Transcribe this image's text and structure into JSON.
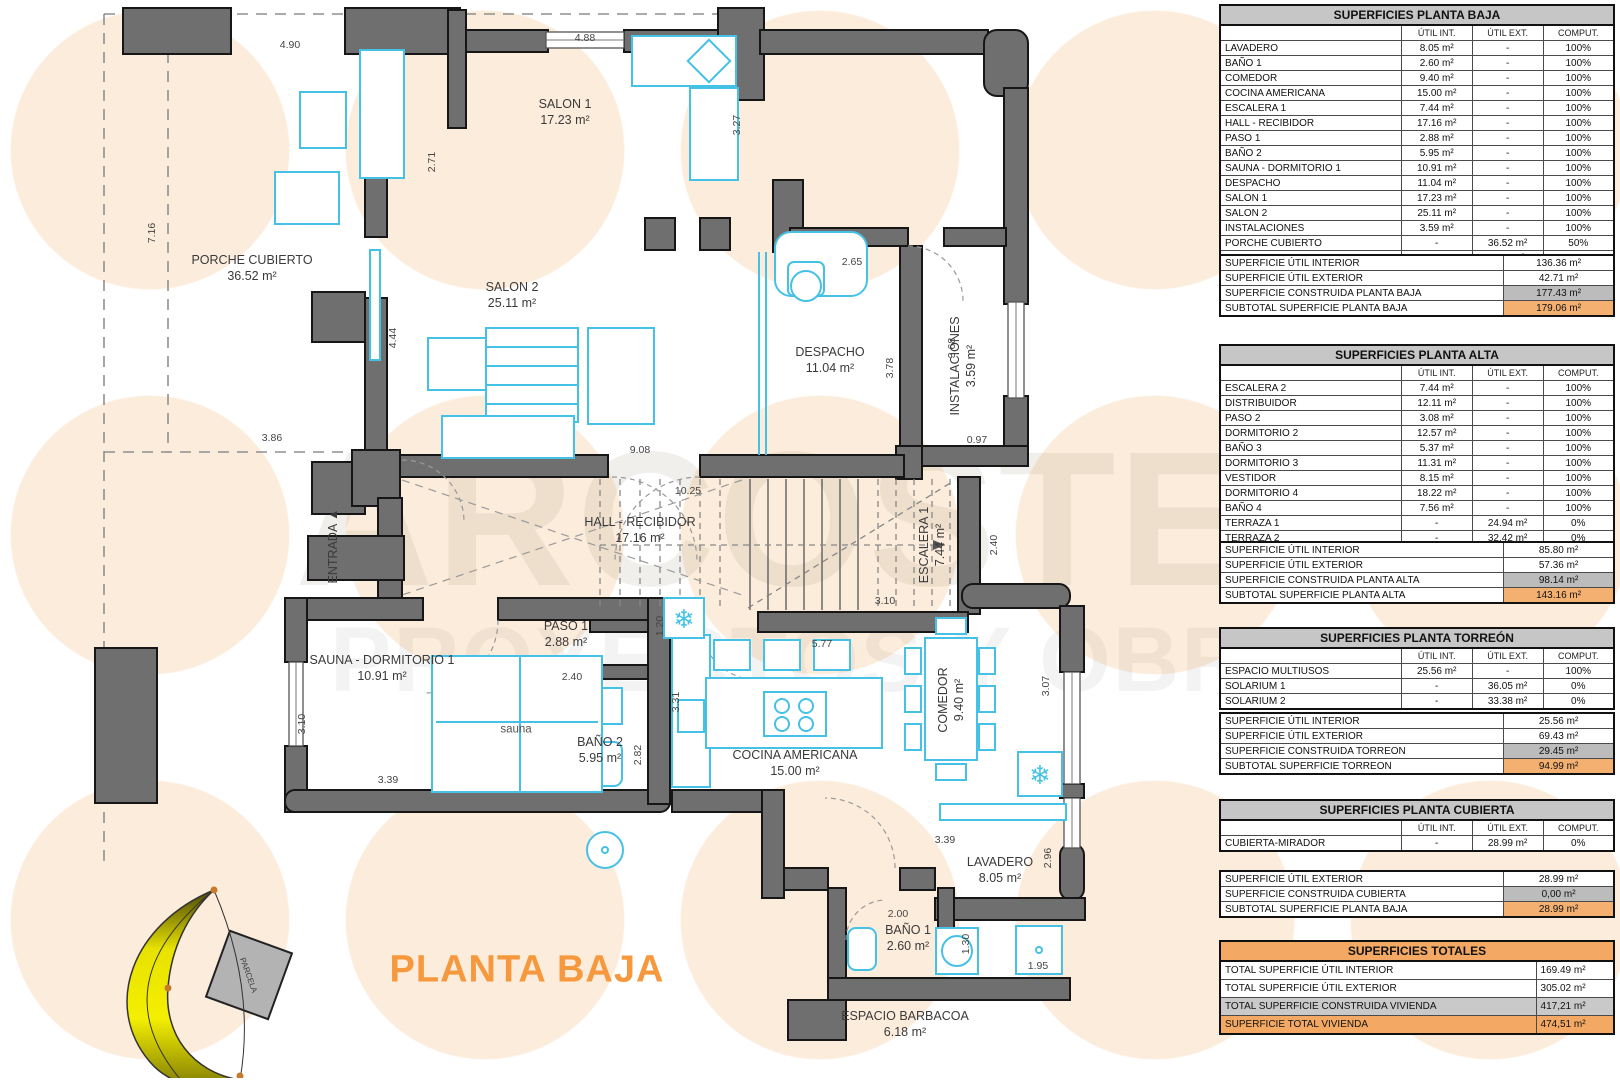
{
  "title": "PLANTA BAJA",
  "watermark": {
    "line1": "ARCOSTEC",
    "line2": "PROYECTOS Y OBRAS"
  },
  "colors": {
    "accent_orange": "#F6993E",
    "table_header_gray": "#C6C6C6",
    "highlight_gray": "#BCBCBC",
    "highlight_orange": "#F3B071",
    "totals_header_orange": "#F3A963",
    "wall_gray": "#6F6F6F",
    "furniture_cyan": "#45C1E5",
    "sun_yellow": "#E8E200"
  },
  "plan": {
    "rooms": [
      {
        "name": "PORCHE CUBIERTO",
        "area": "36.52 m²"
      },
      {
        "name": "SALON 1",
        "area": "17.23 m²"
      },
      {
        "name": "SALON 2",
        "area": "25.11 m²"
      },
      {
        "name": "DESPACHO",
        "area": "11.04 m²"
      },
      {
        "name": "INSTALACIONES",
        "area": "3.59 m²"
      },
      {
        "name": "HALL - RECIBIDOR",
        "area": "17.16 m²"
      },
      {
        "name": "ESCALERA 1",
        "area": "7.44 m²"
      },
      {
        "name": "SAUNA - DORMITORIO 1",
        "area": "10.91 m²"
      },
      {
        "name": "PASO 1",
        "area": "2.88 m²"
      },
      {
        "name": "BAÑO 2",
        "area": "5.95 m²"
      },
      {
        "name": "COCINA AMERICANA",
        "area": "15.00 m²"
      },
      {
        "name": "COMEDOR",
        "area": "9.40 m²"
      },
      {
        "name": "LAVADERO",
        "area": "8.05 m²"
      },
      {
        "name": "BAÑO 1",
        "area": "2.60 m²"
      },
      {
        "name": "ESPACIO BARBACOA",
        "area": "6.18 m²"
      }
    ],
    "labels": {
      "sauna": "sauna",
      "entrada": "ENTRADA",
      "parcela": "PARCELA"
    },
    "dims": [
      "4.90",
      "7.16",
      "2.71",
      "4.88",
      "3.27",
      "4.44",
      "3.86",
      "9.08",
      "2.65",
      "3.78",
      "3.68",
      "0.97",
      "10.25",
      "2.40",
      "3.10",
      "5.77",
      "1.20",
      "3.31",
      "2.40",
      "2.82",
      "3.10",
      "3.39",
      "3.07",
      "3.39",
      "2.96",
      "2.00",
      "1.30",
      "1.95"
    ]
  },
  "tables": {
    "baja": {
      "title": "SUPERFICIES PLANTA BAJA",
      "columns": [
        "ÚTIL INT.",
        "ÚTIL EXT.",
        "COMPUT."
      ],
      "rows": [
        {
          "name": "LAVADERO",
          "int": "8.05 m²",
          "ext": "-",
          "comp": "100%"
        },
        {
          "name": "BAÑO 1",
          "int": "2.60 m²",
          "ext": "-",
          "comp": "100%"
        },
        {
          "name": "COMEDOR",
          "int": "9.40 m²",
          "ext": "-",
          "comp": "100%"
        },
        {
          "name": "COCINA AMERICANA",
          "int": "15.00 m²",
          "ext": "-",
          "comp": "100%"
        },
        {
          "name": "ESCALERA 1",
          "int": "7.44 m²",
          "ext": "-",
          "comp": "100%"
        },
        {
          "name": "HALL - RECIBIDOR",
          "int": "17.16 m²",
          "ext": "-",
          "comp": "100%"
        },
        {
          "name": "PASO 1",
          "int": "2.88 m²",
          "ext": "-",
          "comp": "100%"
        },
        {
          "name": "BAÑO 2",
          "int": "5.95 m²",
          "ext": "-",
          "comp": "100%"
        },
        {
          "name": "SAUNA - DORMITORIO 1",
          "int": "10.91 m²",
          "ext": "-",
          "comp": "100%"
        },
        {
          "name": "DESPACHO",
          "int": "11.04 m²",
          "ext": "-",
          "comp": "100%"
        },
        {
          "name": "SALON 1",
          "int": "17.23 m²",
          "ext": "-",
          "comp": "100%"
        },
        {
          "name": "SALON 2",
          "int": "25.11 m²",
          "ext": "-",
          "comp": "100%"
        },
        {
          "name": "INSTALACIONES",
          "int": "3.59 m²",
          "ext": "-",
          "comp": "100%"
        },
        {
          "name": "PORCHE CUBIERTO",
          "int": "-",
          "ext": "36.52 m²",
          "comp": "50%"
        },
        {
          "name": "ESPACIO BARBACOA",
          "int": "-",
          "ext": "6.18 m²",
          "comp": "0%"
        }
      ]
    },
    "baja_summary": {
      "rows": [
        {
          "label": "SUPERFICIE ÚTIL INTERIOR",
          "value": "136.36 m²"
        },
        {
          "label": "SUPERFICIE ÚTIL EXTERIOR",
          "value": "42.71 m²"
        },
        {
          "label": "SUPERFICIE CONSTRUIDA PLANTA BAJA",
          "value": "177.43 m²"
        },
        {
          "label": "SUBTOTAL SUPERFICIE PLANTA BAJA",
          "value": "179.06 m²"
        }
      ]
    },
    "alta": {
      "title": "SUPERFICIES PLANTA ALTA",
      "columns": [
        "ÚTIL INT.",
        "ÚTIL EXT.",
        "COMPUT."
      ],
      "rows": [
        {
          "name": "ESCALERA 2",
          "int": "7.44 m²",
          "ext": "-",
          "comp": "100%"
        },
        {
          "name": "DISTRIBUIDOR",
          "int": "12.11 m²",
          "ext": "-",
          "comp": "100%"
        },
        {
          "name": "PASO 2",
          "int": "3.08 m²",
          "ext": "-",
          "comp": "100%"
        },
        {
          "name": "DORMITORIO 2",
          "int": "12.57 m²",
          "ext": "-",
          "comp": "100%"
        },
        {
          "name": "BAÑO 3",
          "int": "5.37 m²",
          "ext": "-",
          "comp": "100%"
        },
        {
          "name": "DORMITORIO 3",
          "int": "11.31 m²",
          "ext": "-",
          "comp": "100%"
        },
        {
          "name": "VESTIDOR",
          "int": "8.15 m²",
          "ext": "-",
          "comp": "100%"
        },
        {
          "name": "DORMITORIO 4",
          "int": "18.22 m²",
          "ext": "-",
          "comp": "100%"
        },
        {
          "name": "BAÑO 4",
          "int": "7.56 m²",
          "ext": "-",
          "comp": "100%"
        },
        {
          "name": "TERRAZA 1",
          "int": "-",
          "ext": "24.94 m²",
          "comp": "0%"
        },
        {
          "name": "TERRAZA 2",
          "int": "-",
          "ext": "32.42 m²",
          "comp": "0%"
        }
      ]
    },
    "alta_summary": {
      "rows": [
        {
          "label": "SUPERFICIE ÚTIL INTERIOR",
          "value": "85.80 m²"
        },
        {
          "label": "SUPERFICIE ÚTIL EXTERIOR",
          "value": "57.36 m²"
        },
        {
          "label": "SUPERFICIE CONSTRUIDA PLANTA ALTA",
          "value": "98.14 m²"
        },
        {
          "label": "SUBTOTAL SUPERFICIE PLANTA ALTA",
          "value": "143.16 m²"
        }
      ]
    },
    "torreon": {
      "title": "SUPERFICIES PLANTA TORREÓN",
      "columns": [
        "ÚTIL INT.",
        "ÚTIL EXT.",
        "COMPUT."
      ],
      "rows": [
        {
          "name": "ESPACIO MULTIUSOS",
          "int": "25.56 m²",
          "ext": "-",
          "comp": "100%"
        },
        {
          "name": "SOLARIUM 1",
          "int": "-",
          "ext": "36.05 m²",
          "comp": "0%"
        },
        {
          "name": "SOLARIUM 2",
          "int": "-",
          "ext": "33.38 m²",
          "comp": "0%"
        }
      ]
    },
    "torreon_summary": {
      "rows": [
        {
          "label": "SUPERFICIE ÚTIL INTERIOR",
          "value": "25.56 m²"
        },
        {
          "label": "SUPERFICIE ÚTIL EXTERIOR",
          "value": "69.43 m²"
        },
        {
          "label": "SUPERFICIE CONSTRUIDA TORREON",
          "value": "29.45 m²"
        },
        {
          "label": "SUBTOTAL SUPERFICIE TORREON",
          "value": "94.99 m²"
        }
      ]
    },
    "cubierta": {
      "title": "SUPERFICIES PLANTA CUBIERTA",
      "columns": [
        "ÚTIL INT.",
        "ÚTIL EXT.",
        "COMPUT."
      ],
      "rows": [
        {
          "name": "CUBIERTA-MIRADOR",
          "int": "-",
          "ext": "28.99 m²",
          "comp": "0%"
        }
      ]
    },
    "cubierta_summary": {
      "rows": [
        {
          "label": "SUPERFICIE ÚTIL EXTERIOR",
          "value": "28.99 m²"
        },
        {
          "label": "SUPERFICIE CONSTRUIDA CUBIERTA",
          "value": "0,00 m²"
        },
        {
          "label": "SUBTOTAL SUPERFICIE PLANTA BAJA",
          "value": "28.99 m²"
        }
      ]
    },
    "totales": {
      "title": "SUPERFICIES TOTALES",
      "rows": [
        {
          "label": "TOTAL SUPERFICIE ÚTIL INTERIOR",
          "value": "169.49 m²"
        },
        {
          "label": "TOTAL SUPERFICIE ÚTIL EXTERIOR",
          "value": "305.02 m²"
        },
        {
          "label": "TOTAL SUPERFICIE CONSTRUIDA VIVIENDA",
          "value": "417,21 m²"
        },
        {
          "label": "SUPERFICIE TOTAL VIVIENDA",
          "value": "474,51 m²"
        }
      ]
    }
  }
}
